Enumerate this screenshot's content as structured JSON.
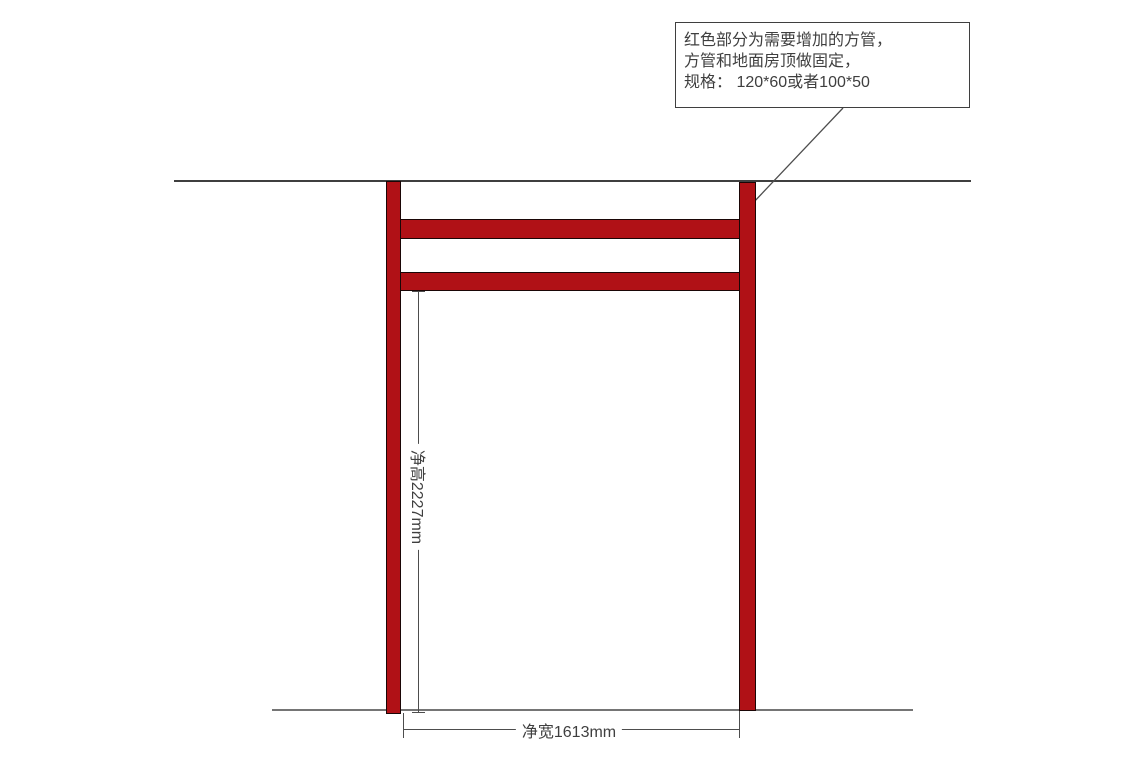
{
  "colors": {
    "background": "#ffffff",
    "tube_fill": "#b01116",
    "tube_outline": "#1a0606",
    "ceiling_line": "#3f3f3f",
    "floor_line": "#757575",
    "dim_line": "#4d4d4d",
    "box_border": "#3f3f3f",
    "text": "#3f3f3f"
  },
  "annotation": {
    "lines": [
      "红色部分为需要增加的方管，",
      "方管和地面房顶做固定，",
      "规格： 120*60或者100*50"
    ]
  },
  "dimensions": {
    "height": {
      "label": "净高2227mm"
    },
    "width": {
      "label": "净宽1613mm"
    }
  }
}
